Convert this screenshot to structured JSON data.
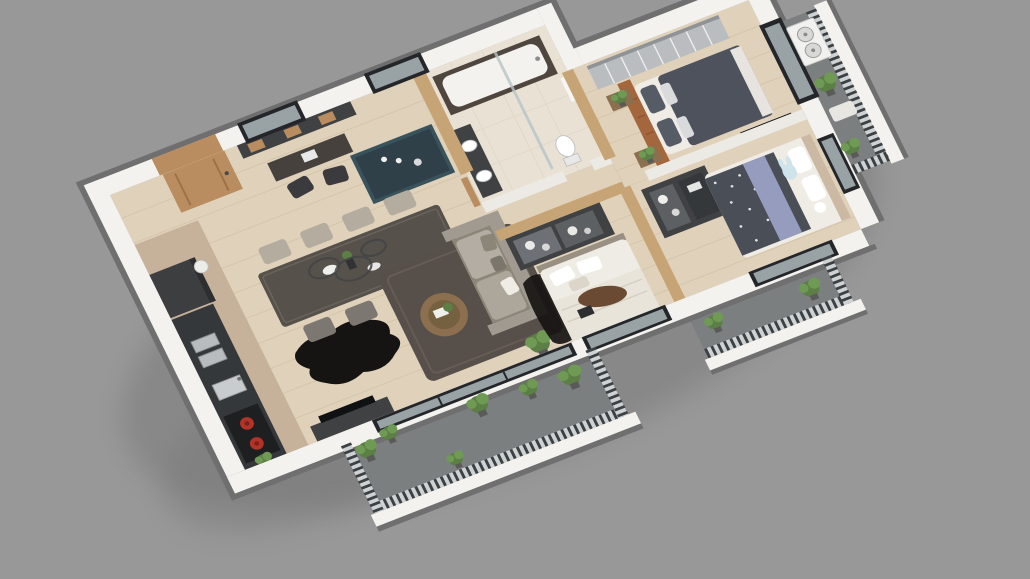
{
  "scene": {
    "type": "3d-floor-plan-render",
    "view": "isometric-top-down",
    "background_color": "#989898",
    "rooms": [
      {
        "name": "open-living-dining-kitchen",
        "furniture": [
          "kitchen-counter-with-red-burners",
          "refrigerator",
          "kitchen-island-teal",
          "dining-table",
          "dining-chairs-x8",
          "ring-chandelier",
          "black-fur-rug",
          "study-desk-nook",
          "desk-chairs-x2",
          "wall-shelf",
          "sofa-with-cushions",
          "round-coffee-table",
          "area-rug",
          "tv-console",
          "floor-lamp",
          "entry-door"
        ]
      },
      {
        "name": "bathroom",
        "furniture": [
          "bathtub-marble-apron",
          "double-basin-vanity",
          "toilet",
          "glass-shower-screen"
        ]
      },
      {
        "name": "corridor",
        "furniture": []
      },
      {
        "name": "middle-bedroom",
        "furniture": [
          "glass-door-wardrobe",
          "white-double-bed",
          "brown-throw",
          "laptop",
          "dark-fur-rug"
        ]
      },
      {
        "name": "master-bedroom",
        "furniture": [
          "mirrored-wardrobe",
          "leather-headboard-panel",
          "double-bed-gray-duvet",
          "nightstands-x2",
          "plants-x2",
          "large-window",
          "tv-panel"
        ]
      },
      {
        "name": "kids-bedroom",
        "furniture": [
          "dark-wardrobe-with-toys",
          "bed-star-duvet",
          "lavender-blanket",
          "bunny-pillow",
          "wood-headboard"
        ]
      }
    ],
    "balconies": [
      {
        "name": "living-balcony",
        "items": [
          "slat-railing",
          "planters",
          "potted-plants"
        ]
      },
      {
        "name": "kids-balcony",
        "items": [
          "slat-railing",
          "potted-plants"
        ]
      },
      {
        "name": "right-balcony",
        "items": [
          "slat-railing",
          "air-conditioner-unit",
          "bench",
          "potted-plants"
        ]
      }
    ],
    "equipment": [
      "air-conditioner-outdoor-unit"
    ]
  },
  "colors": {
    "background": "#989898",
    "shadow": "#747474",
    "wall_white": "#f3f2ee",
    "wall_edge": "#6f6f6f",
    "wall_int": "#eceae4",
    "wood_wall": "#c6a475",
    "door_wood": "#b98d5f",
    "wood_floor": "#e0d2ba",
    "plank_line": "#c9b89d",
    "marble": "#c6b19a",
    "tile": "#e9e2d4",
    "tile_line": "#d8d0c0",
    "deck": "#7c7f80",
    "railing_base": "#cfd2d2",
    "slat": "#3a4043",
    "glass": "#b7c3c6",
    "dark_furn": "#3f4143",
    "teal": "#38535c",
    "table": "#57514b",
    "chair_light": "#b4ac9f",
    "chair_dark": "#7c7770",
    "sofa": "#a09a90",
    "sofa_dark": "#8c8679",
    "rug": "#57504a",
    "fur": "#161412",
    "white_soft": "#efece6",
    "duvet": "#4d525c",
    "kids_duvet": "#4a4e56",
    "lavender": "#959cbd",
    "headboard": "#a4663c",
    "mirror": "#b9bdc0",
    "plant": "#5b7f45",
    "plant2": "#6f9a54",
    "ac_white": "#f1f1ef",
    "burner_red": "#b23327",
    "window_dark": "#24262a",
    "wood_item": "#8b6f4e"
  }
}
